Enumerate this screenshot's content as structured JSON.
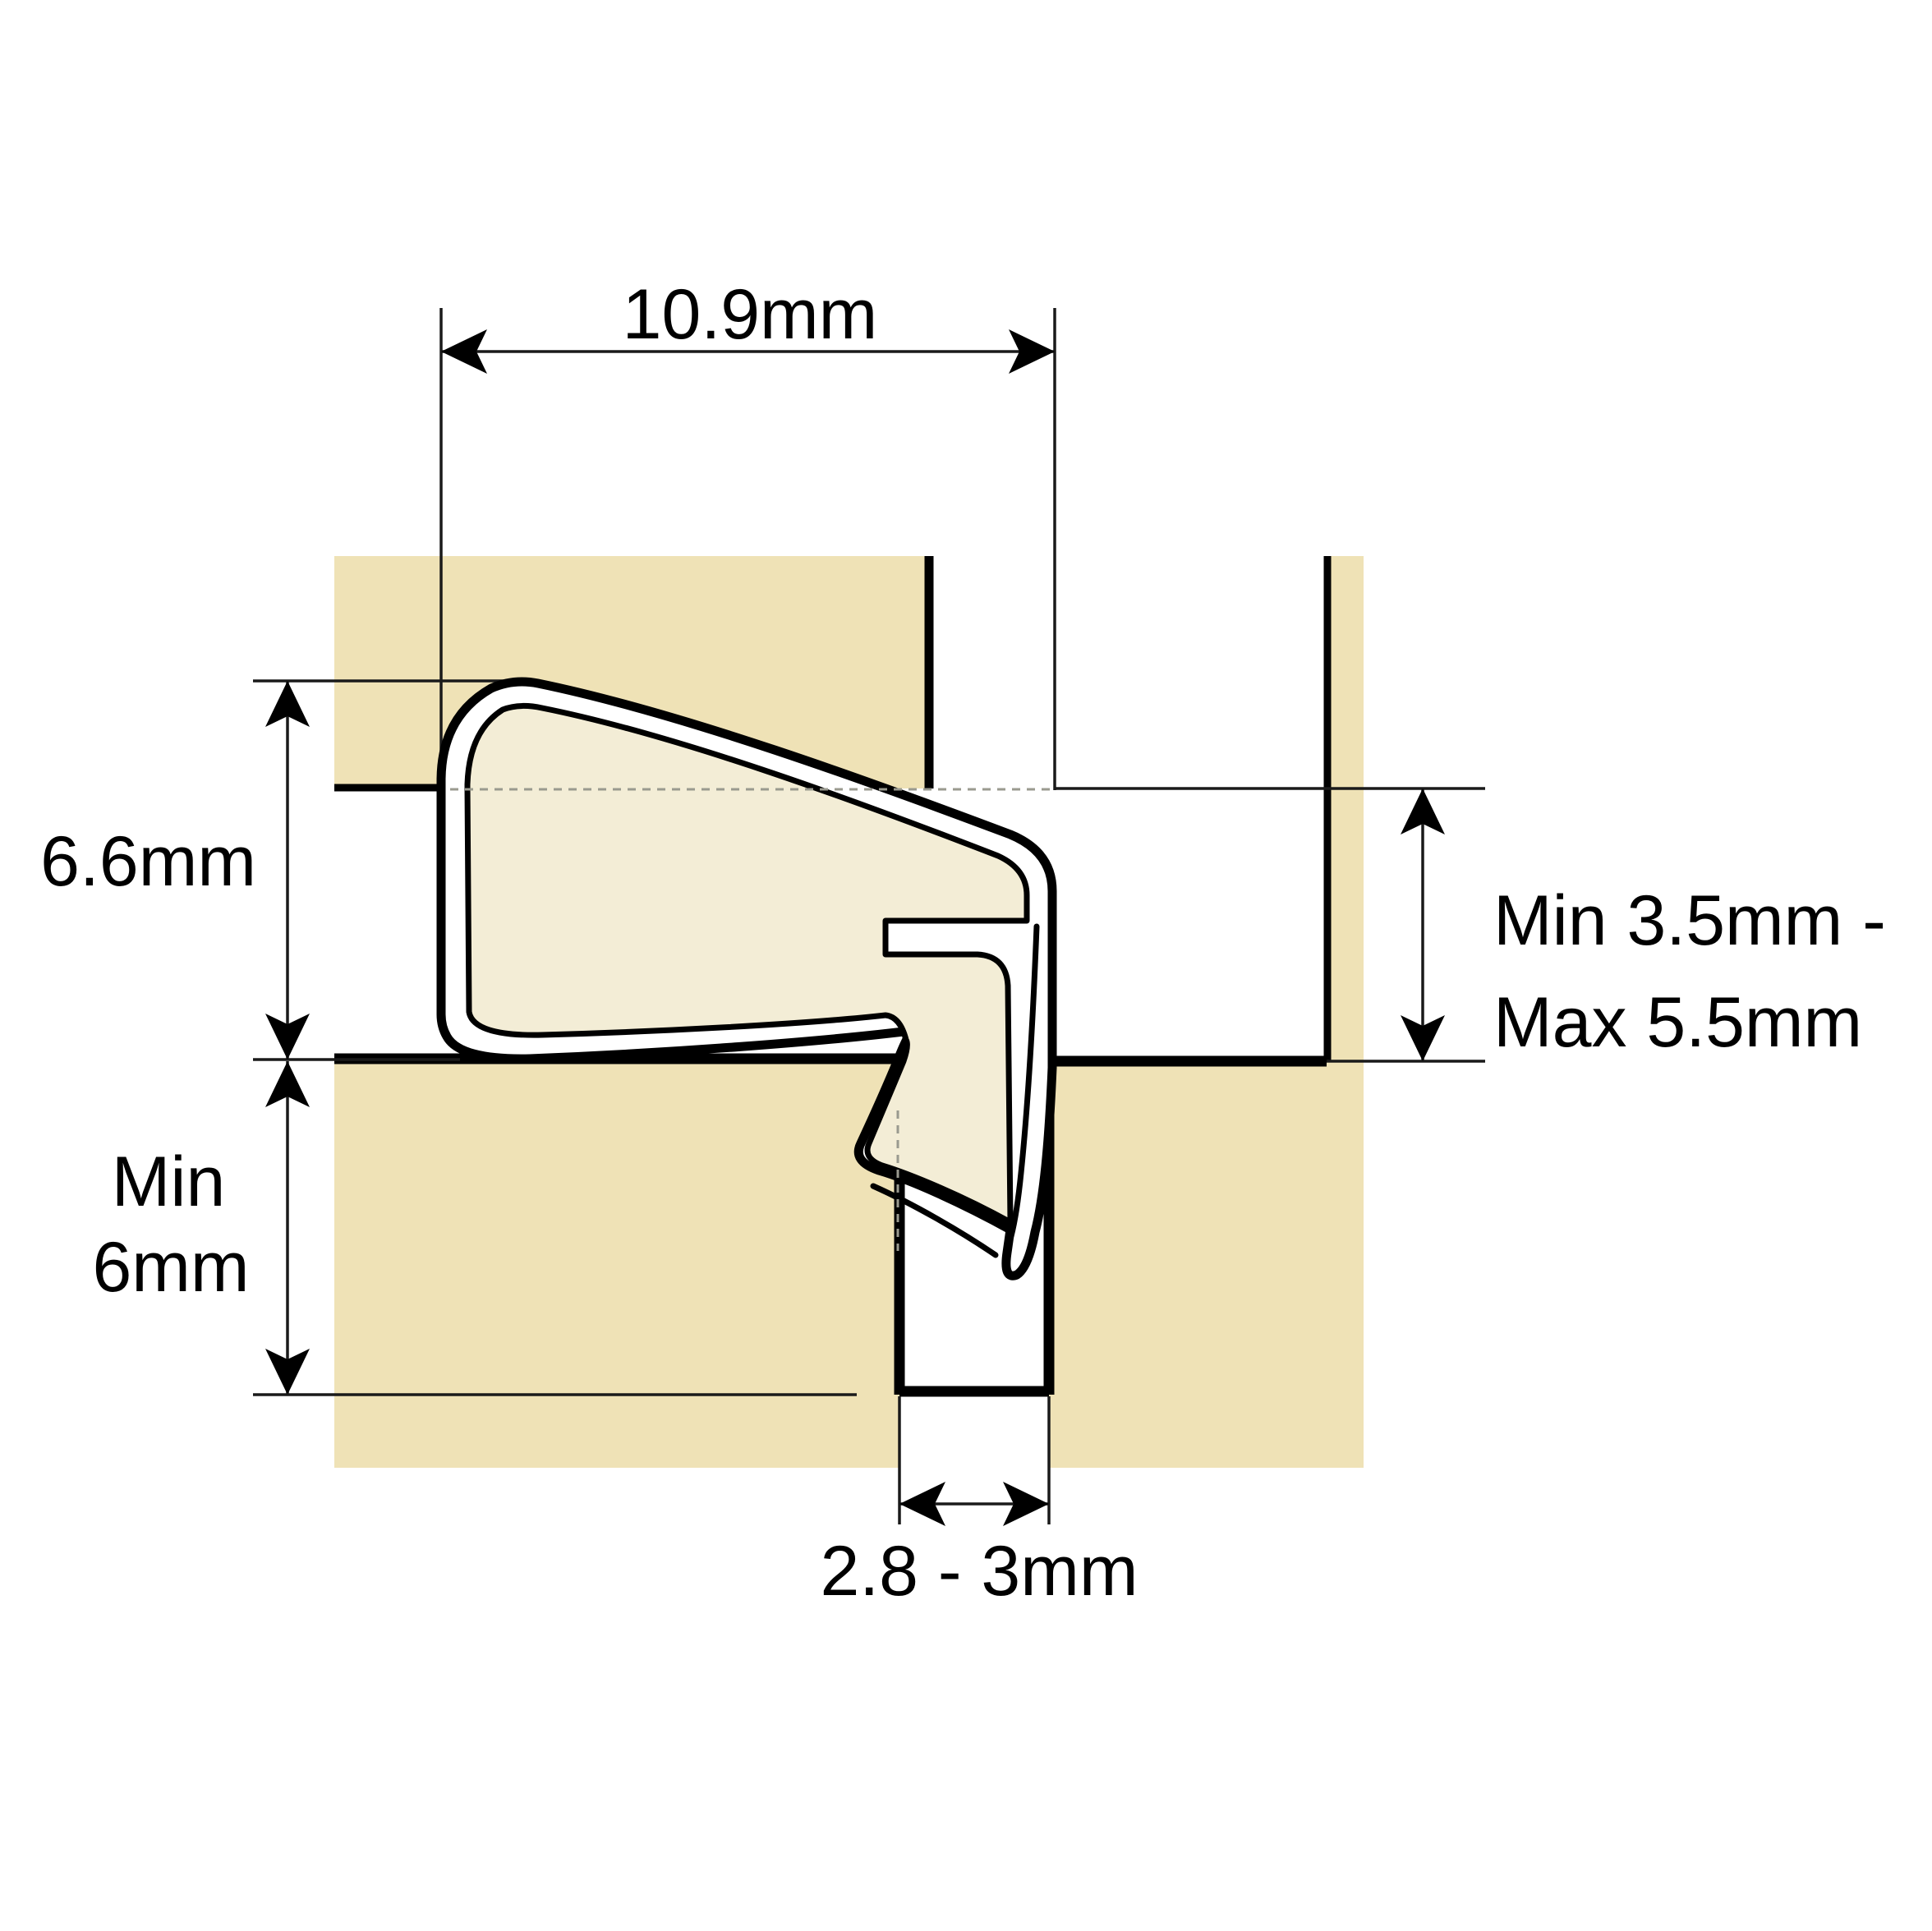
{
  "diagram": {
    "title": "Weatherseal profile installation cross-section",
    "type": "technical-drawing"
  },
  "colors": {
    "background": "#ffffff",
    "wood": "#efe2b6",
    "seal_wall": "#ffffff",
    "seal_body": "#f3edd6",
    "outline": "#000000",
    "hidden_line": "#9a9a8f"
  },
  "dimensions": {
    "overall_width": {
      "label": "10.9mm"
    },
    "overall_height": {
      "label": "6.6mm"
    },
    "groove_depth": {
      "label_line1": "Min",
      "label_line2": "6mm"
    },
    "gap_range": {
      "label_line1": "Min 3.5mm -",
      "label_line2": "Max 5.5mm"
    },
    "groove_width": {
      "label": "2.8 - 3mm"
    }
  }
}
